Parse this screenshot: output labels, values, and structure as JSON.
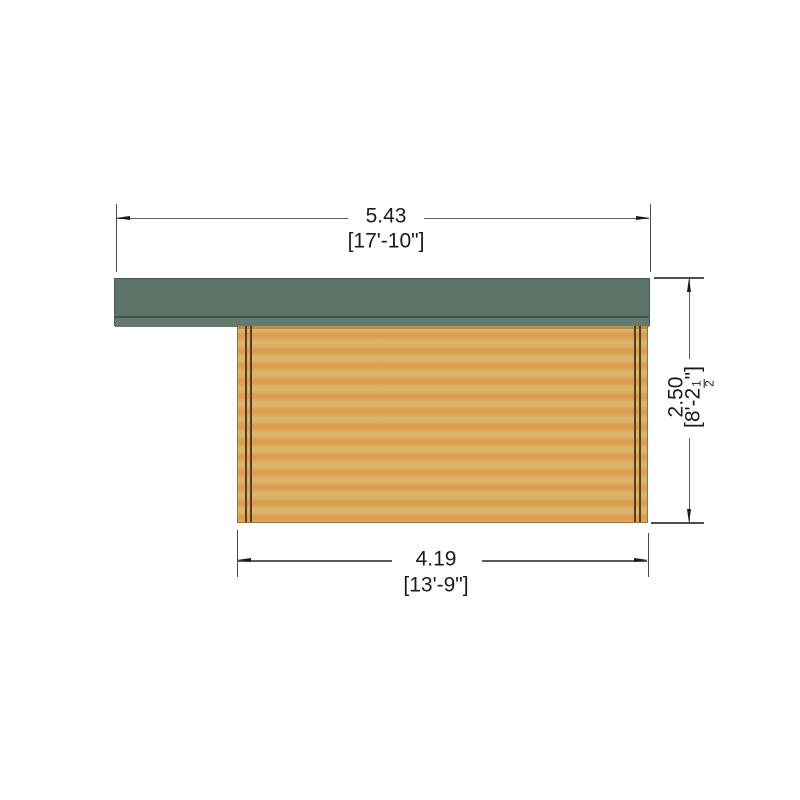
{
  "drawing": {
    "title": "log-cabin-side-elevation",
    "dim_top": {
      "metric": "5.43",
      "imperial": "[17'-10\"]"
    },
    "dim_bottom": {
      "metric": "4.19",
      "imperial": "[13'-9\"]"
    },
    "dim_right": {
      "metric": "2.50",
      "imperial_prefix": "[8'-2",
      "frac_num": "1",
      "frac_den": "2",
      "imperial_suffix": "\"]"
    },
    "colors": {
      "roof_main": "#5d7468",
      "roof_edge_line": "#3f5349",
      "roof_fascia": "#647a6e",
      "wall_light": "#d8b569",
      "wall_dark": "#de9d4e",
      "wall_outline": "#96723c",
      "corner_trim": "#5a3c1e",
      "dimension_line": "#5c5c5c",
      "dimension_text": "#1b1b1b",
      "background": "#ffffff"
    }
  }
}
